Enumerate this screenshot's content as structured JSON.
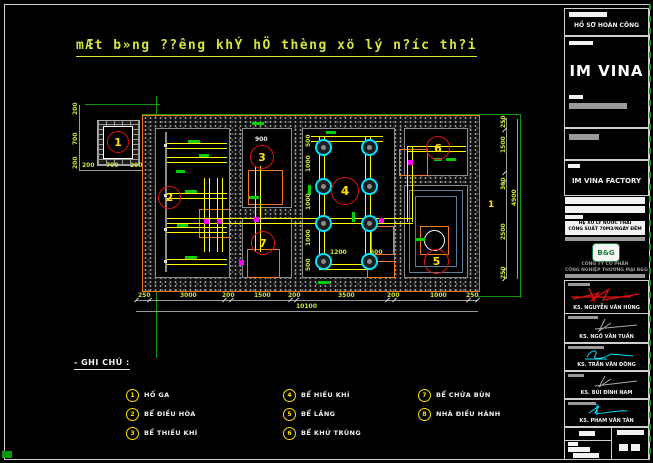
{
  "sheet": {
    "title": "mÆt b»ng ??êng khÝ hÖ thèng xö lý n?íc th?i",
    "axis_label": "1",
    "room3_dim": "900"
  },
  "callouts": {
    "c1": "1",
    "c2": "2",
    "c3": "3",
    "c4": "4",
    "c5": "5",
    "c6": "6",
    "c7": "7"
  },
  "dims": {
    "bottom": [
      "250",
      "3000",
      "200",
      "1500",
      "200",
      "3500",
      "200",
      "1000",
      "250"
    ],
    "bottom_total": "10100",
    "right": [
      "250",
      "1500",
      "300",
      "2500",
      "250"
    ],
    "right_total": "4900",
    "manhole_left": [
      "200",
      "700",
      "200"
    ],
    "manhole_bottom": [
      "200",
      "700",
      "200"
    ],
    "room4_left": [
      "500",
      "1000",
      "1000",
      "1000",
      "500"
    ],
    "room4_bottom": [
      "1200",
      "600"
    ]
  },
  "legend": {
    "heading": "- GHI CHÚ :",
    "items": [
      {
        "num": "1",
        "label": "HỐ GA"
      },
      {
        "num": "2",
        "label": "BỂ ĐIỀU HÒA"
      },
      {
        "num": "3",
        "label": "BỂ THIẾU KHÍ"
      },
      {
        "num": "4",
        "label": "BỂ HIẾU KHÍ"
      },
      {
        "num": "5",
        "label": "BỂ LẮNG"
      },
      {
        "num": "6",
        "label": "BỂ KHỬ TRÙNG"
      },
      {
        "num": "7",
        "label": "BỂ CHỨA BÙN"
      },
      {
        "num": "8",
        "label": "NHÀ ĐIỀU HÀNH"
      }
    ]
  },
  "titleblock": {
    "header": "HỒ SƠ HOÀN CÔNG",
    "brand": "IM VINA",
    "factory_label": "IM VINA FACTORY",
    "project_line1": "HỆ XỬ LÝ NƯỚC THẢI",
    "project_line2": "CÔNG SUẤT 70M3/NGÀY ĐÊM",
    "logo_text": "B&G",
    "company_line1": "CÔNG TY CỔ PHẦN",
    "company_line2": "CÔNG NGHIỆP THƯƠNG MẠI B&G",
    "sig1_name": "KS. NGUYỄN VĂN HÙNG",
    "sig2_name": "KS. NGÔ VĂN TUẤN",
    "sig3_name": "KS. TRẦN VĂN ĐÔNG",
    "sig4_name": "KS. BÙI ĐÌNH NAM",
    "sig5_name": "KS. PHAM VĂN TÂN"
  }
}
